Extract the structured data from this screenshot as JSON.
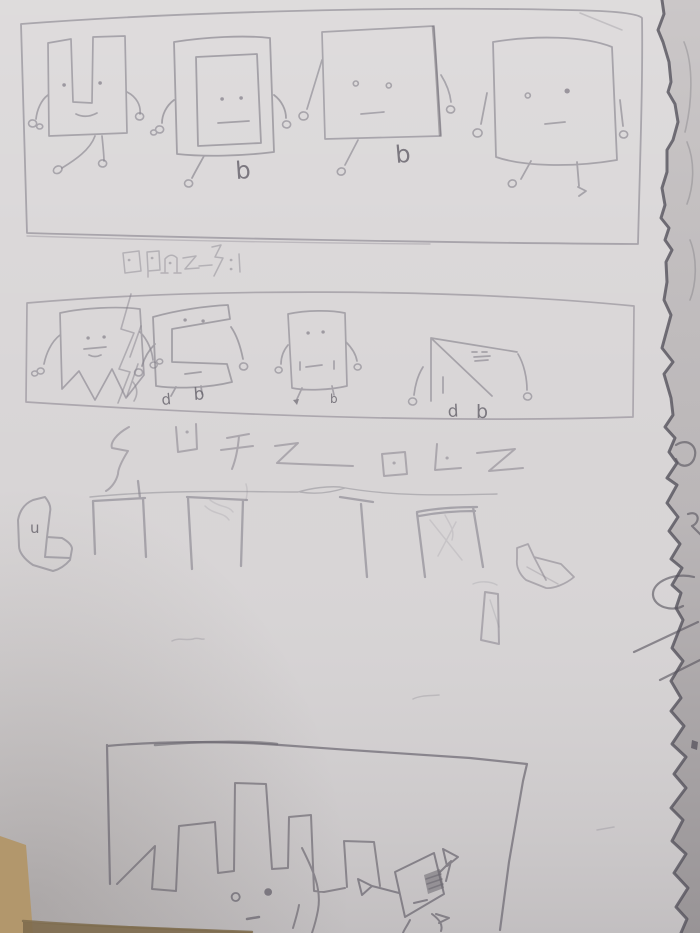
{
  "scene": {
    "description": "Pencil comic sketch on a notebook page: rows of square robot characters, alien glyph captions, a row of arch structures, and a large castle-like robot in the bottom panel. Torn page edge at right, wooden table visible at bottom-left."
  },
  "colors": {
    "paper": "#d8d5d6",
    "side_page": "#cfcbcc",
    "table": "#b2976c",
    "table_dark": "#7e6c4e",
    "pencil": "#86828c",
    "pencil_dark": "#6b6770",
    "pencil_heavy": "#55525c"
  },
  "panels": [
    {
      "name": "panel-1",
      "description": "Four square robots standing in a row, each with dot eyes, wire arms and small feet"
    },
    {
      "name": "panel-2",
      "description": "Four damaged square robots: torn one with a crack, one with a notch bitten out, a patched one, and one collapsed into a triangle"
    },
    {
      "name": "panel-3",
      "description": "Row of table-like arch structures with rubble blobs"
    },
    {
      "name": "panel-4",
      "description": "Large castle-shaped robot with two eyes, and a small cheering square robot beside it"
    }
  ],
  "captions": {
    "row1": "row of six small scribbled alien glyphs",
    "row2": "row of seven larger scribbled alien glyphs"
  },
  "letters": {
    "blob_u": "u",
    "p1c2_b": "b",
    "p1c3_b": "b",
    "p2c2_d": "d",
    "p2c2_b": "b",
    "p2c3_b": "b",
    "p2c4_d": "d",
    "p2c4_b": "b"
  }
}
